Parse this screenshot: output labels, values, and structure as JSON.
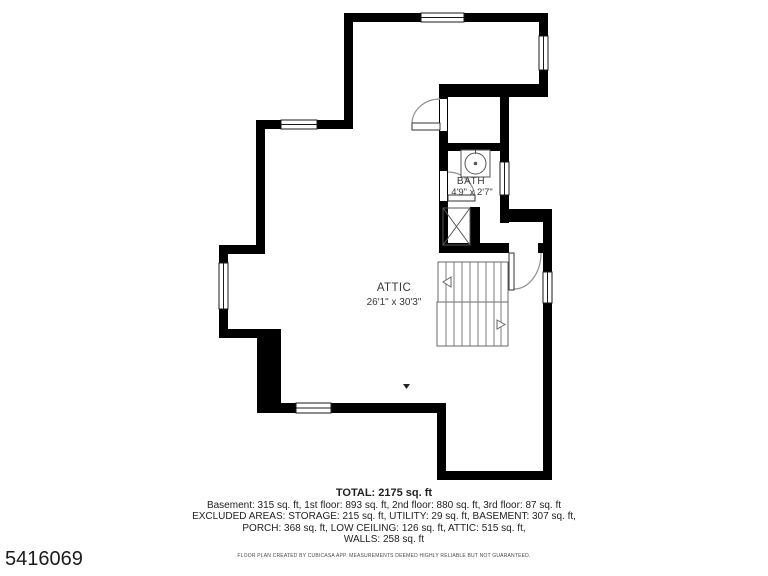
{
  "plan": {
    "attic": {
      "name": "ATTIC",
      "dims": "26'1\" x 30'3\""
    },
    "bath": {
      "name": "BATH",
      "dims": "4'9\" x 2'7\""
    }
  },
  "summary": {
    "total": "TOTAL: 2175 sq. ft",
    "lines": [
      "Basement: 315 sq. ft, 1st floor: 893 sq. ft, 2nd floor: 880 sq. ft, 3rd floor: 87 sq. ft",
      "EXCLUDED AREAS: STORAGE: 215 sq. ft, UTILITY: 29 sq. ft, BASEMENT: 307 sq. ft,",
      "PORCH: 368 sq. ft, LOW CEILING: 126 sq. ft, ATTIC: 515 sq. ft,",
      "WALLS: 258 sq. ft"
    ],
    "disclaimer": "FLOOR PLAN CREATED BY CUBICASA APP. MEASUREMENTS DEEMED HIGHLY RELIABLE BUT NOT GUARANTEED."
  },
  "listing_id": "5416069",
  "colors": {
    "wall": "#000000",
    "stair": "#666666",
    "door": "#909090",
    "fixture": "#555555"
  }
}
